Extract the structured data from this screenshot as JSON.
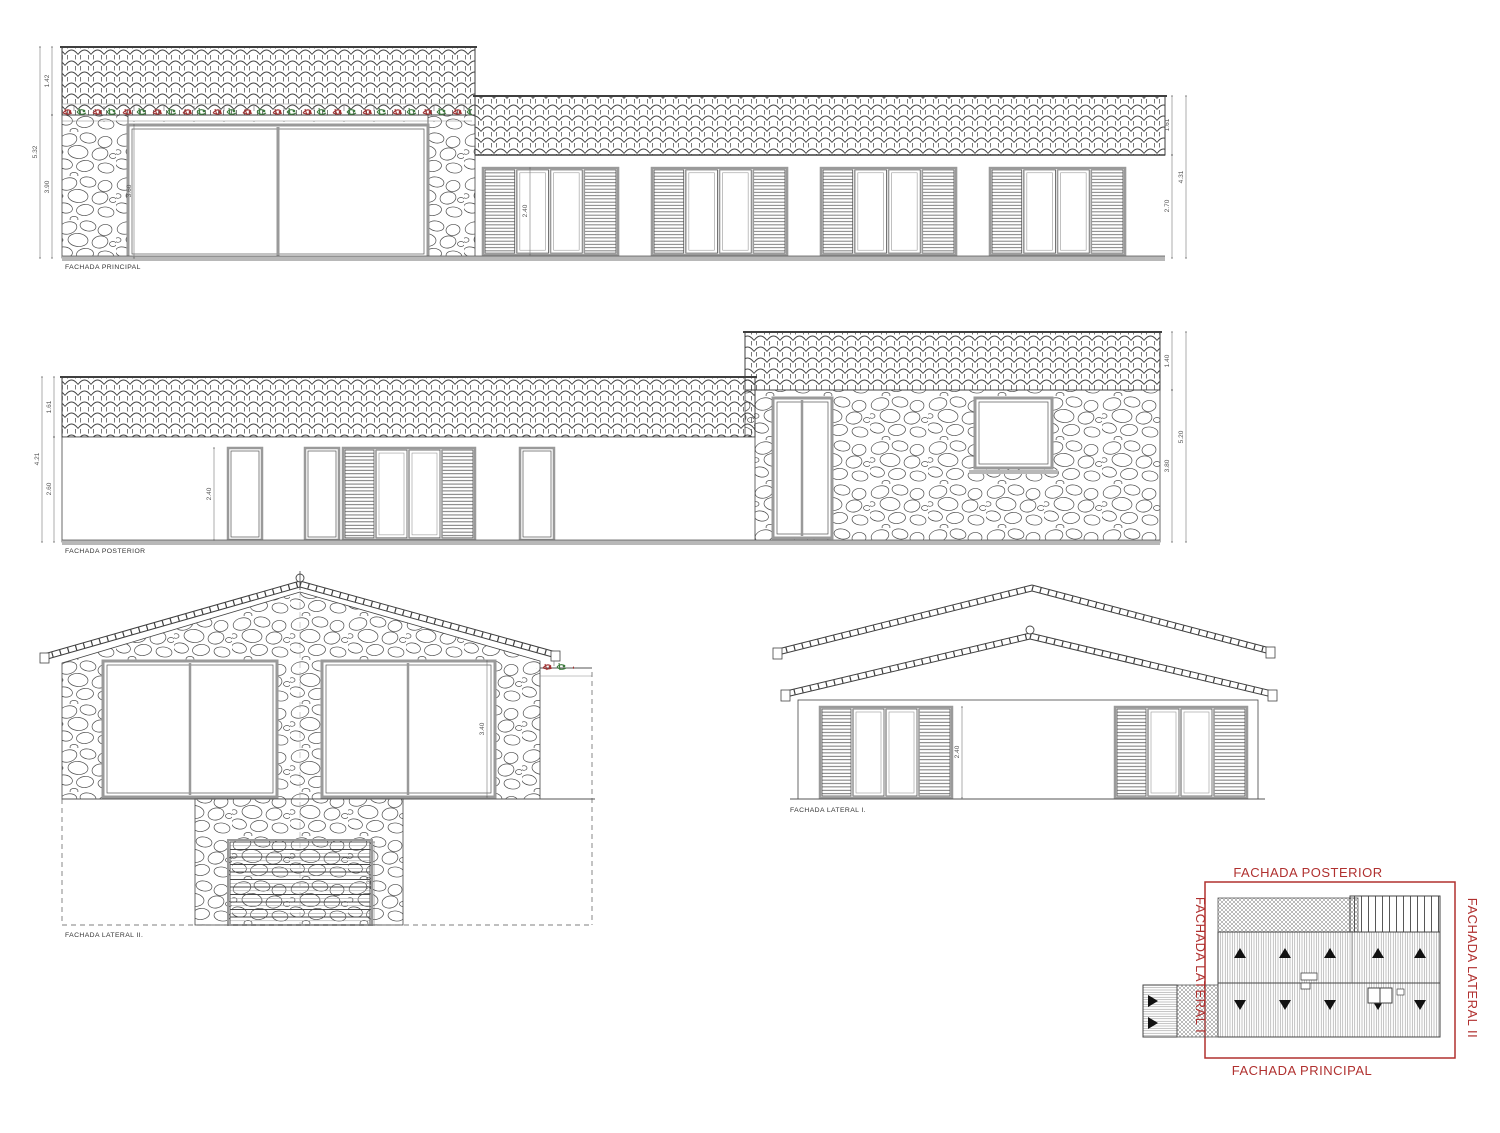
{
  "colors": {
    "line": "#3f3f3f",
    "frame_gray": "#9a9a9a",
    "ground_gray": "#b8b8b8",
    "dim_text": "#555555",
    "red_label": "#b0302f",
    "vegetation_red": "#a03232",
    "vegetation_green": "#3c7a3c"
  },
  "elevations": {
    "principal": {
      "label": "FACHADA PRINCIPAL",
      "dims": {
        "roof": "1.42",
        "wall": "3.90",
        "total": "5.32",
        "window": "3.60",
        "wing_roof": "1.61",
        "wing_wall": "2.70",
        "wing_total": "4.31",
        "wing_window": "2.40"
      }
    },
    "posterior": {
      "label": "FACHADA POSTERIOR",
      "dims": {
        "roof": "1.61",
        "wall": "2.60",
        "total": "4.21",
        "window": "2.40",
        "tall_roof": "1.40",
        "tall_wall": "3.80",
        "tall_total": "5.20"
      }
    },
    "lateral2": {
      "label": "FACHADA LATERAL II.",
      "dims": {
        "window": "3.40",
        "garage": "2.20"
      }
    },
    "lateral1": {
      "label": "FACHADA LATERAL I.",
      "dims": {
        "window": "2.40"
      }
    }
  },
  "key_plan": {
    "top": "FACHADA POSTERIOR",
    "bottom": "FACHADA PRINCIPAL",
    "left": "FACHADA LATERAL I",
    "right": "FACHADA LATERAL II"
  }
}
